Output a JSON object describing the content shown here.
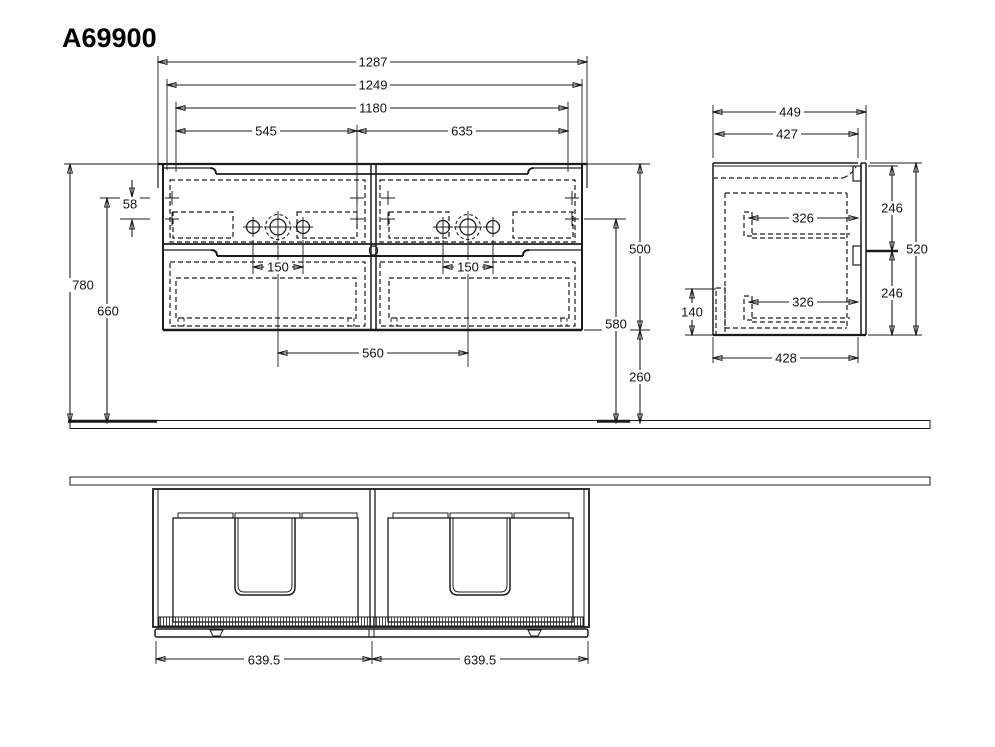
{
  "title": "A69900",
  "front": {
    "basin_width": "1287",
    "cabinet_width": "1249",
    "carcass_width": "1180",
    "span_left": "545",
    "span_right": "635",
    "tap_holes_left": "150",
    "tap_holes_right": "150",
    "basin_center_distance": "560",
    "height_top": "780",
    "height_upper_fix": "660",
    "fix_offset": "58",
    "cabinet_height": "500",
    "height_lower_fix": "580",
    "floor_clearance": "260"
  },
  "side": {
    "depth_total": "449",
    "depth_body": "427",
    "drawer_inner_top": "326",
    "drawer_inner_bottom": "326",
    "front_upper": "246",
    "front_lower": "246",
    "body_height": "520",
    "depth_bottom": "428",
    "rail_height": "140"
  },
  "bottom": {
    "half_left": "639.5",
    "half_right": "639.5"
  }
}
